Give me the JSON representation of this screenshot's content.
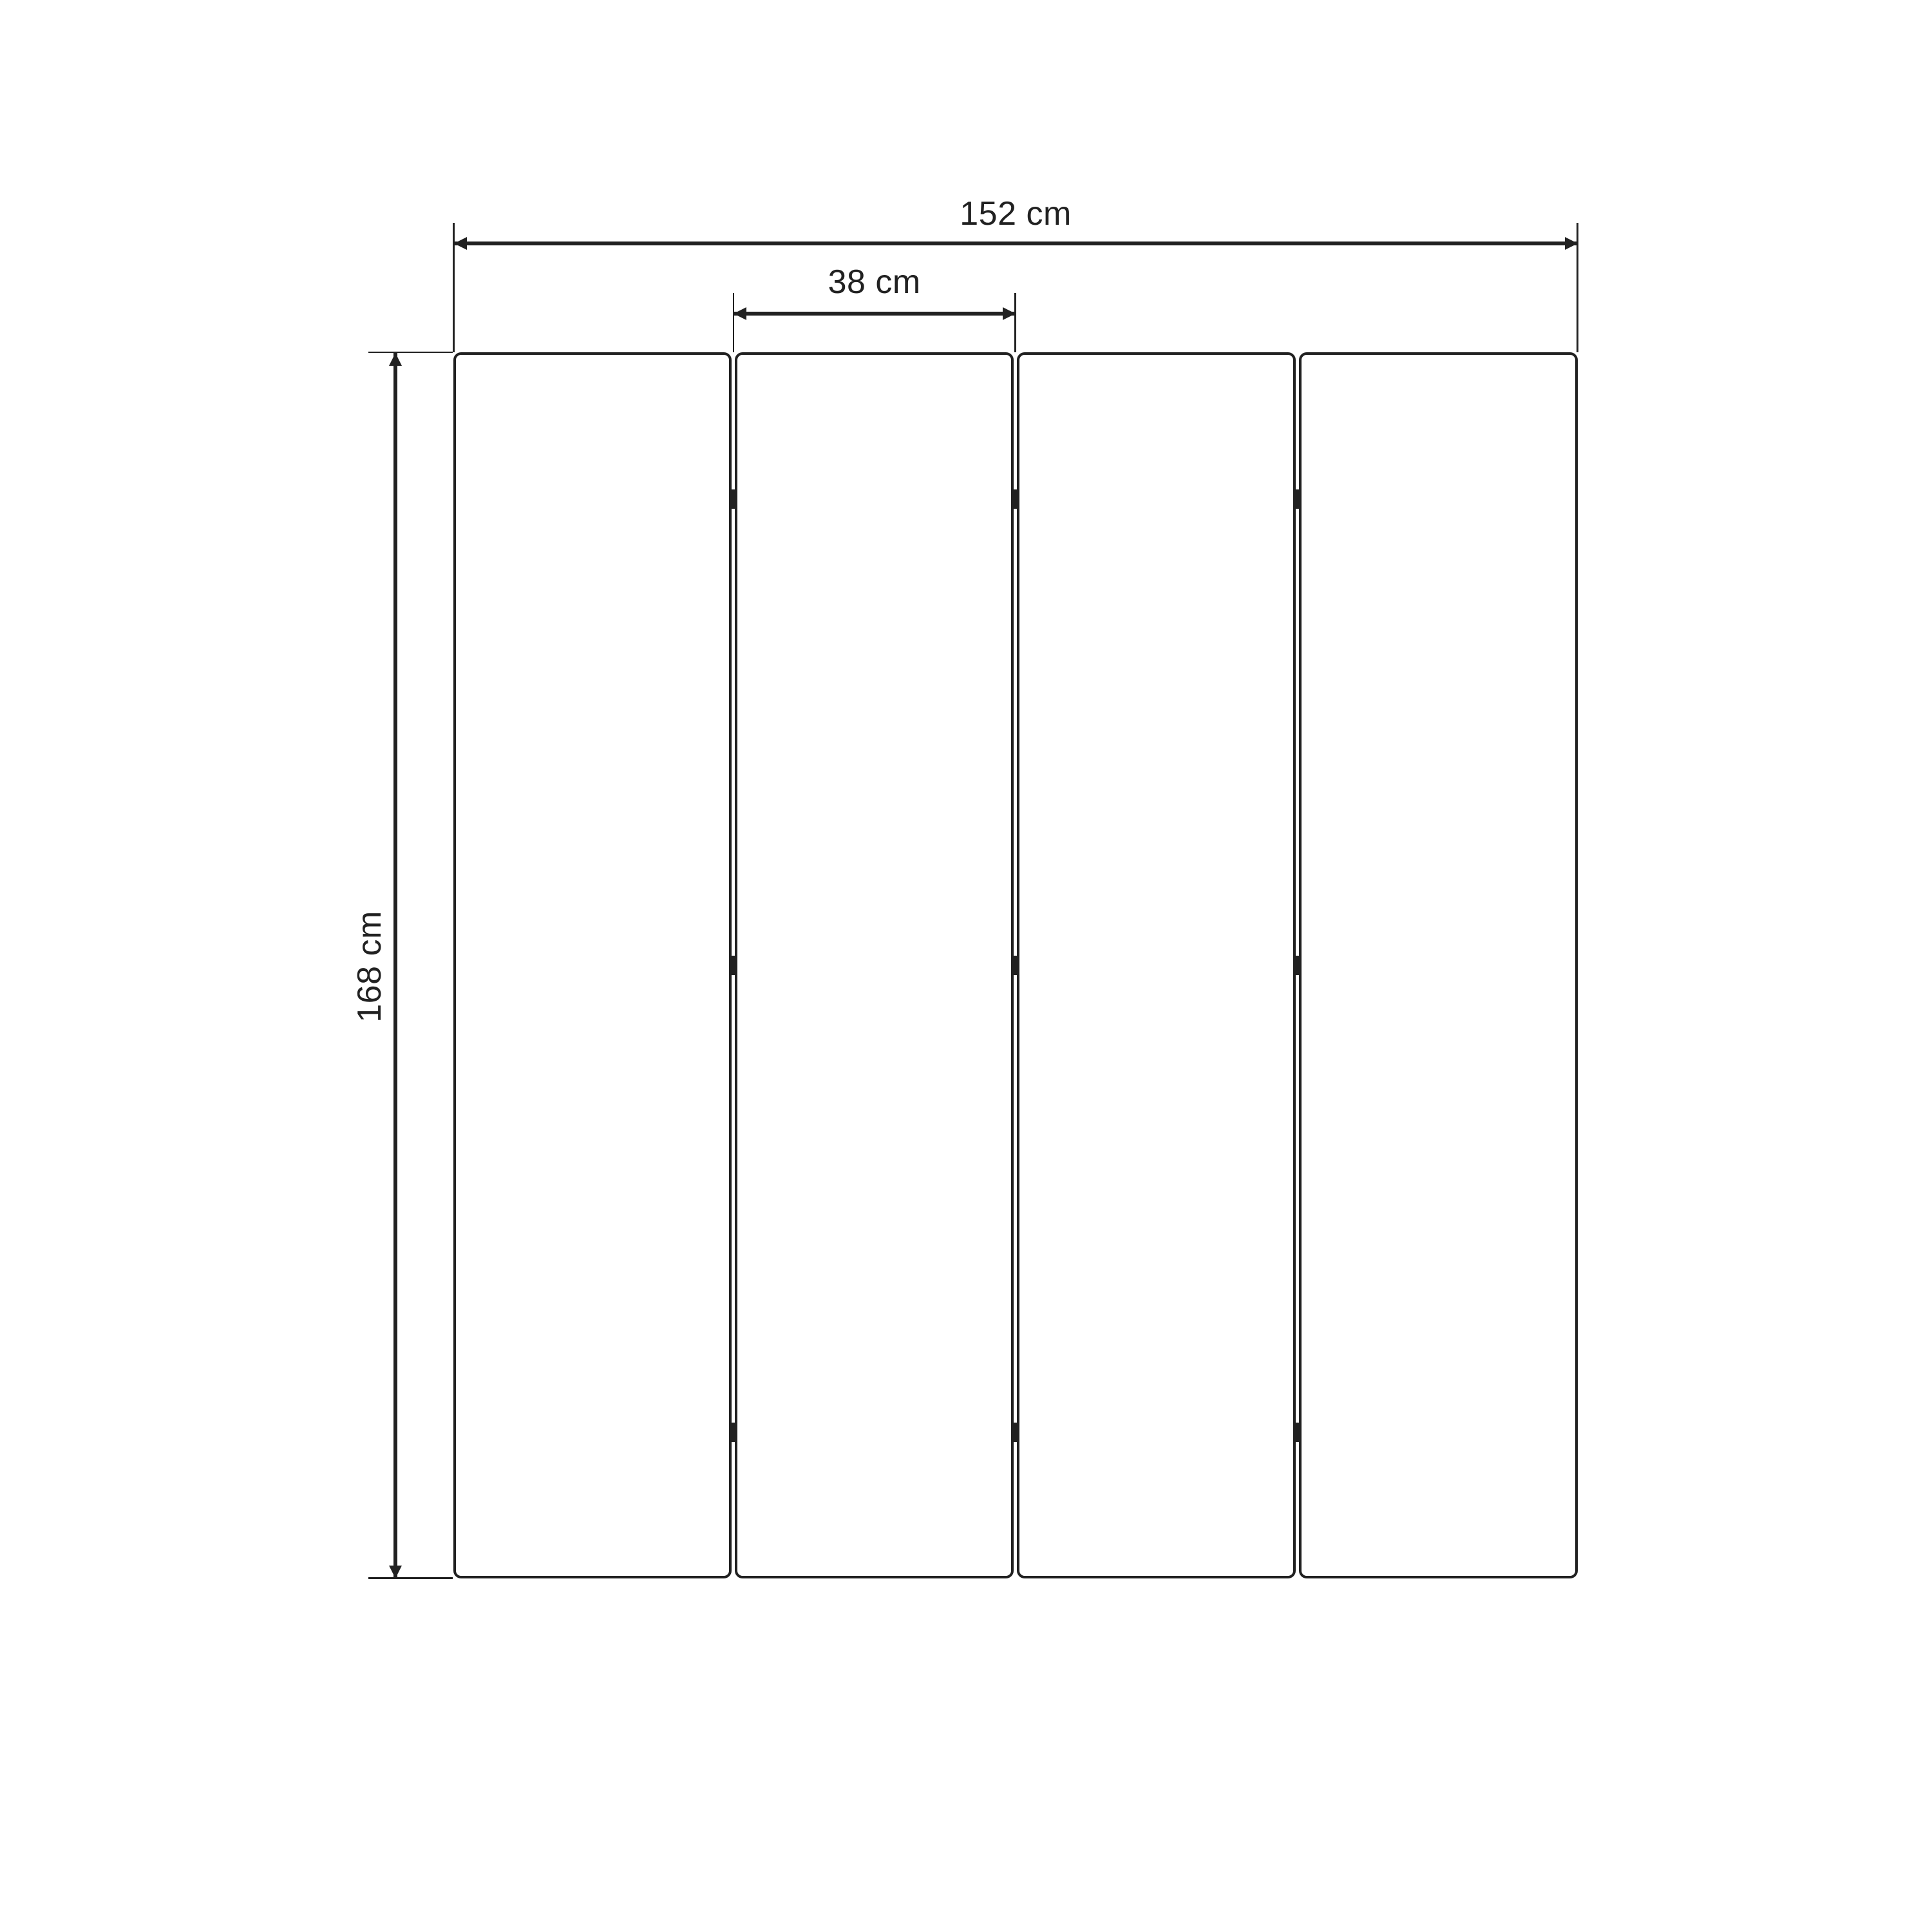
{
  "diagram": {
    "type": "dimension-drawing",
    "subject": "four-panel folding screen, front view",
    "background_color": "#ffffff",
    "line_color": "#212121",
    "panel_count": 4,
    "hinge_columns": 3,
    "hinge_rows": 3,
    "dimensions": {
      "total_width": {
        "label": "152 cm",
        "value": 152,
        "unit": "cm"
      },
      "panel_width": {
        "label": "38 cm",
        "value": 38,
        "unit": "cm"
      },
      "height": {
        "label": "168 cm",
        "value": 168,
        "unit": "cm"
      }
    }
  }
}
